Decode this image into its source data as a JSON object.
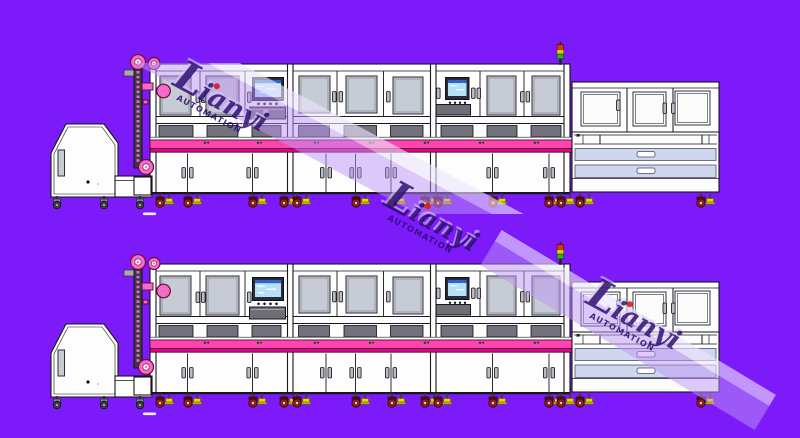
{
  "title": "automated-production-line-cad-drawing",
  "watermark": {
    "initial": "L",
    "rest": "ianyi",
    "sub": "AUTOMATION"
  },
  "rows": {
    "count": 2,
    "top_label": "production-line-top",
    "bottom_label": "production-line-bottom"
  },
  "colors": {
    "background": "#7c1afa",
    "machine_body": "#fdfdfd",
    "outline": "#17171c",
    "window_gray": "#c6cbd4",
    "conveyor_pink": "#ff44b2",
    "conveyor_dark_pink": "#e4008e",
    "pulley_pink": "#f36cc8",
    "drawer_lavender": "#ced6f0",
    "tray_gray": "#6e6e76",
    "slot_gray": "#72727c",
    "screen_blue": "#b5e0f5",
    "screen_header_blue": "#2e66c8",
    "caster_red": "#8c1d1d",
    "foot_yellow": "#e8d800",
    "tower_red": "#e03020",
    "tower_yellow": "#f0c000",
    "tower_green": "#30b030",
    "watermark_text": "#2a0b6e",
    "watermark_accent_red": "#e01818",
    "watermark_shadow": "#d9c9f8",
    "watermark_band": "rgba(190,150,245,0.5)",
    "watermark_band_bright": "rgba(238,229,255,0.62)"
  }
}
